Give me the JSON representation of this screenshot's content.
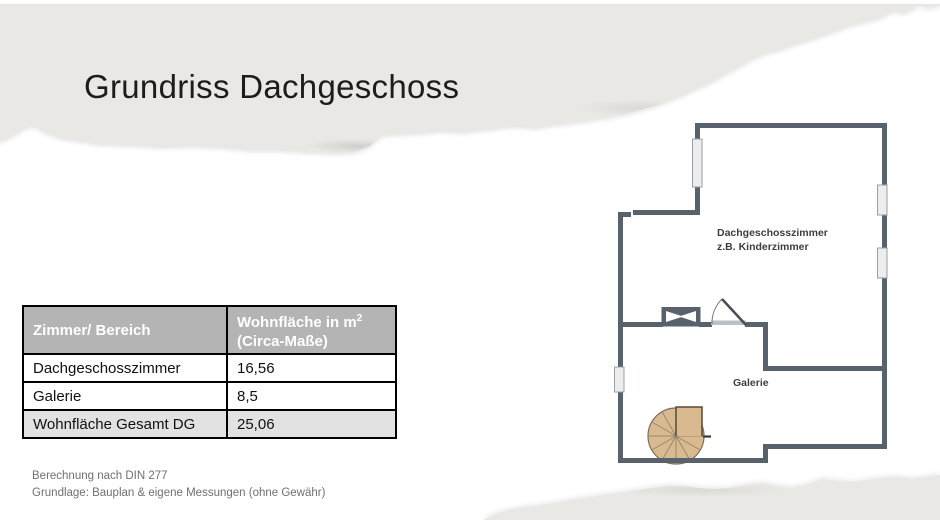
{
  "title": "Grundriss Dachgeschoss",
  "table": {
    "header": {
      "col1": "Zimmer/ Bereich",
      "col2_line1": "Wohnfläche in m",
      "col2_sup": "2",
      "col2_line2": "(Circa-Maße)"
    },
    "rows": [
      {
        "label": "Dachgeschosszimmer",
        "value": "16,56"
      },
      {
        "label": "Galerie",
        "value": "8,5"
      },
      {
        "label": "Wohnfläche Gesamt DG",
        "value": "25,06"
      }
    ]
  },
  "floorplan": {
    "room1_label_line1": "Dachgeschosszimmer",
    "room1_label_line2": "z.B. Kinderzimmer",
    "room2_label": "Galerie"
  },
  "footer": {
    "line1": "Berechnung nach DIN 277",
    "line2": "Grundlage: Bauplan & eigene Messungen (ohne Gewähr)"
  },
  "colors": {
    "paper_grey": "#e9e8e5",
    "wall": "#57626c",
    "window_fill": "#ededed",
    "stair_wood": "#d9ba90",
    "table_header_bg": "#b4b4b4",
    "table_total_bg": "#e2e2e2"
  }
}
